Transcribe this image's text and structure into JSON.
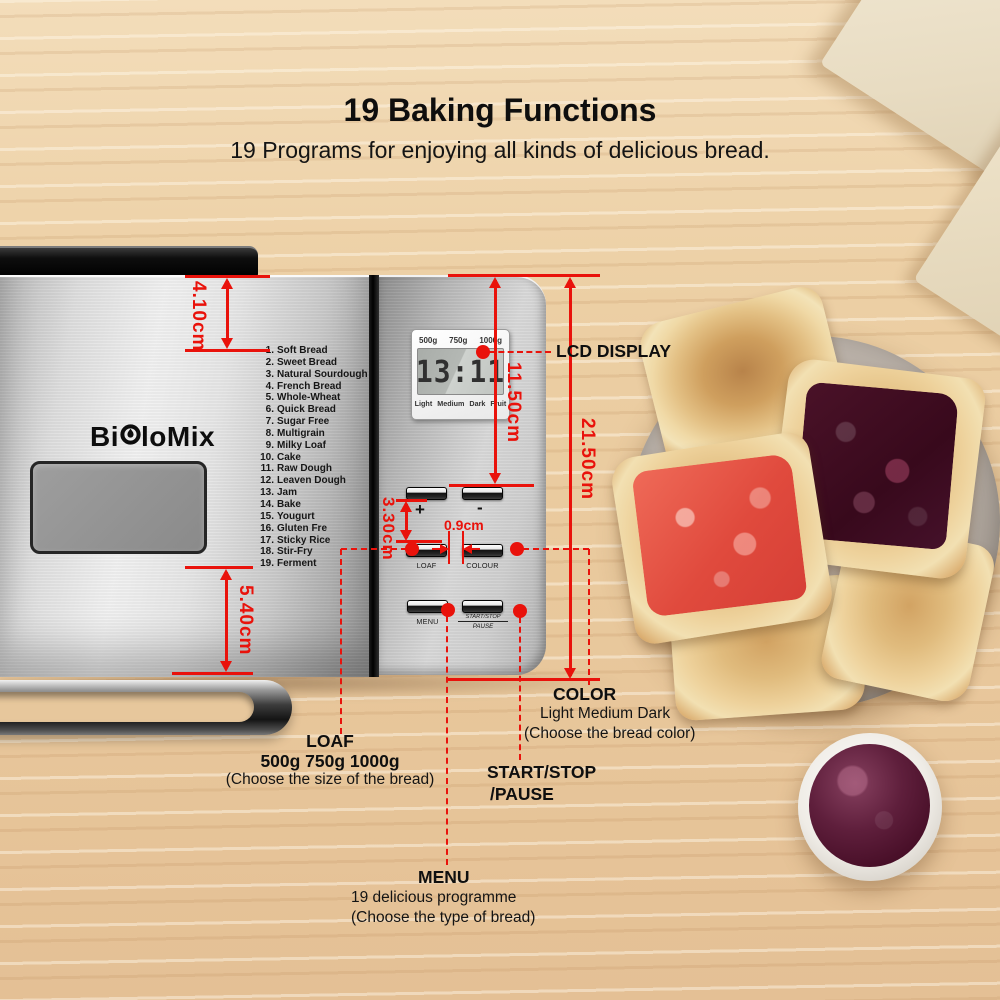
{
  "header": {
    "title": "19 Baking Functions",
    "subtitle": "19 Programs for enjoying all kinds of delicious bread."
  },
  "brand": {
    "name_left": "Bi",
    "name_right": "loMix"
  },
  "machine": {
    "programs": [
      {
        "num": "1.",
        "name": "Soft Bread"
      },
      {
        "num": "2.",
        "name": "Sweet Bread"
      },
      {
        "num": "3.",
        "name": "Natural Sourdough"
      },
      {
        "num": "4.",
        "name": "French Bread"
      },
      {
        "num": "5.",
        "name": "Whole-Wheat"
      },
      {
        "num": "6.",
        "name": "Quick Bread"
      },
      {
        "num": "7.",
        "name": "Sugar Free"
      },
      {
        "num": "8.",
        "name": "Multigrain"
      },
      {
        "num": "9.",
        "name": "Milky Loaf"
      },
      {
        "num": "10.",
        "name": "Cake"
      },
      {
        "num": "11.",
        "name": "Raw Dough"
      },
      {
        "num": "12.",
        "name": "Leaven Dough"
      },
      {
        "num": "13.",
        "name": "Jam"
      },
      {
        "num": "14.",
        "name": "Bake"
      },
      {
        "num": "15.",
        "name": "Yougurt"
      },
      {
        "num": "16.",
        "name": "Gluten Fre"
      },
      {
        "num": "17.",
        "name": "Sticky Rice"
      },
      {
        "num": "18.",
        "name": "Stir-Fry"
      },
      {
        "num": "19.",
        "name": "Ferment"
      }
    ],
    "lcd": {
      "weights": [
        "500g",
        "750g",
        "1000g"
      ],
      "time": "13:11",
      "modes": [
        "Light",
        "Medium",
        "Dark",
        "Fruit"
      ]
    },
    "buttons": {
      "plus": "+",
      "minus": "-",
      "loaf": "LOAF",
      "colour": "COLOUR",
      "menu": "MENU",
      "start_stop": "START/STOP",
      "pause": "PAUSE"
    }
  },
  "dimensions": {
    "handle_height": "4.10cm",
    "lcd_to_buttons": "11.50cm",
    "panel_height": "21.50cm",
    "bottom_section": "5.40cm",
    "row_gap": "3.30cm",
    "button_gap": "0.9cm"
  },
  "callouts": {
    "lcd": {
      "label": "LCD DISPLAY"
    },
    "color": {
      "title": "COLOR",
      "options": "Light Medium Dark",
      "hint": "(Choose the  bread color)"
    },
    "loaf": {
      "title": "LOAF",
      "options": "500g  750g 1000g",
      "hint": "(Choose the size of the bread)"
    },
    "start": {
      "title": "START/STOP",
      "title2": "/PAUSE"
    },
    "menu": {
      "title": "MENU",
      "options": "19 delicious programme",
      "hint": "(Choose the type of bread)"
    }
  },
  "colors": {
    "accent_red": "#e9120b"
  }
}
